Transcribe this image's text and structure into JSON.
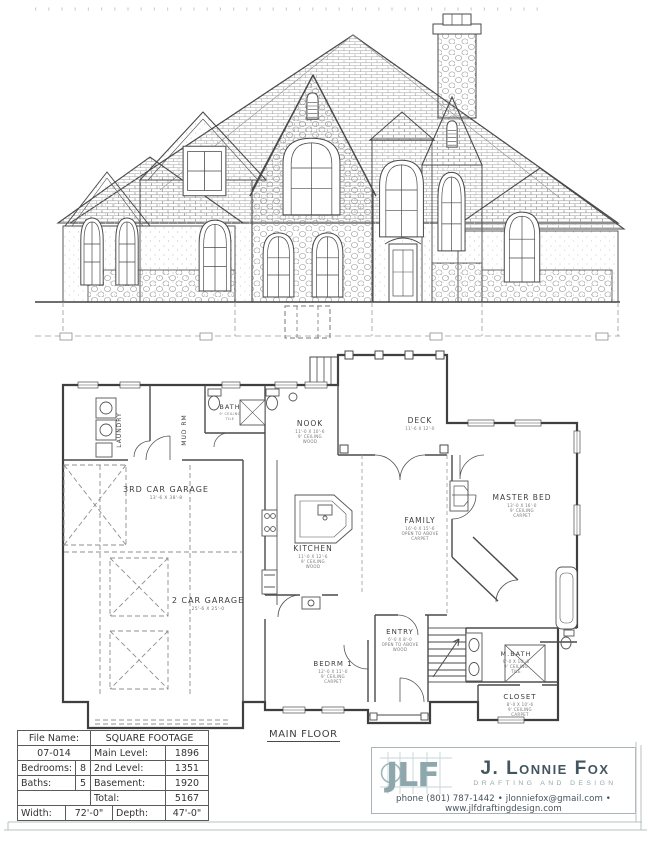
{
  "sheet": {
    "bg": "#ffffff",
    "line": "#4a4a4a",
    "pattern_line": "#8f8f8f",
    "frame": "#b9c0c3"
  },
  "plan": {
    "label": "MAIN FLOOR",
    "rooms": [
      {
        "name": "LAUNDRY"
      },
      {
        "name": "MUD RM"
      },
      {
        "name": "BATH",
        "sub1": "9' CEILING",
        "sub2": "TILE"
      },
      {
        "name": "NOOK",
        "sub1": "11'-0 X 10'-6",
        "sub2": "9' CEILING",
        "sub3": "WOOD"
      },
      {
        "name": "DECK",
        "sub1": "11'-6 X 12'-0"
      },
      {
        "name": "3RD CAR GARAGE",
        "sub1": "13'-6 X 38'-8"
      },
      {
        "name": "2 CAR GARAGE",
        "sub1": "25'-6 X 25'-0"
      },
      {
        "name": "KITCHEN",
        "sub1": "11'-0 X 12'-6",
        "sub2": "9' CEILING",
        "sub3": "WOOD"
      },
      {
        "name": "FAMILY",
        "sub1": "16'-0 X 15'-6",
        "sub2": "OPEN TO ABOVE",
        "sub3": "CARPET"
      },
      {
        "name": "MASTER BED",
        "sub1": "13'-0 X 16'-0",
        "sub2": "9' CEILING",
        "sub3": "CARPET"
      },
      {
        "name": "ENTRY",
        "sub1": "6'-0 X 8'-0",
        "sub2": "OPEN TO ABOVE",
        "sub3": "WOOD"
      },
      {
        "name": "BEDRM 1",
        "sub1": "12'-0 X 11'-0",
        "sub2": "9' CEILING",
        "sub3": "CARPET"
      },
      {
        "name": "M.BATH",
        "sub1": "9'-0 X 10'-6",
        "sub2": "9' CEILING",
        "sub3": "TILE"
      },
      {
        "name": "CLOSET",
        "sub1": "8'-0 X 10'-6",
        "sub2": "9' CEILING",
        "sub3": "CARPET"
      }
    ]
  },
  "title_block": {
    "file_name_label": "File Name:",
    "file_name_value": "07-014",
    "sq_header": "SQUARE FOOTAGE",
    "bedrooms_label": "Bedrooms:",
    "bedrooms_value": "8",
    "baths_label": "Baths:",
    "baths_value": "5",
    "main_label": "Main Level:",
    "main_value": "1896",
    "second_label": "2nd Level:",
    "second_value": "1351",
    "basement_label": "Basement:",
    "basement_value": "1920",
    "total_label": "Total:",
    "total_value": "5167",
    "width_label": "Width:",
    "width_value": "72'-0\"",
    "depth_label": "Depth:",
    "depth_value": "47'-0\""
  },
  "logo": {
    "initials": "JLF",
    "name": "J. Lonnie Fox",
    "tagline": "DRAFTING AND DESIGN",
    "contact": "phone (801) 787-1442 • jlonniefox@gmail.com • www.jlfdraftingdesign.com",
    "accent": "#8da7ac",
    "dark": "#43565f"
  }
}
